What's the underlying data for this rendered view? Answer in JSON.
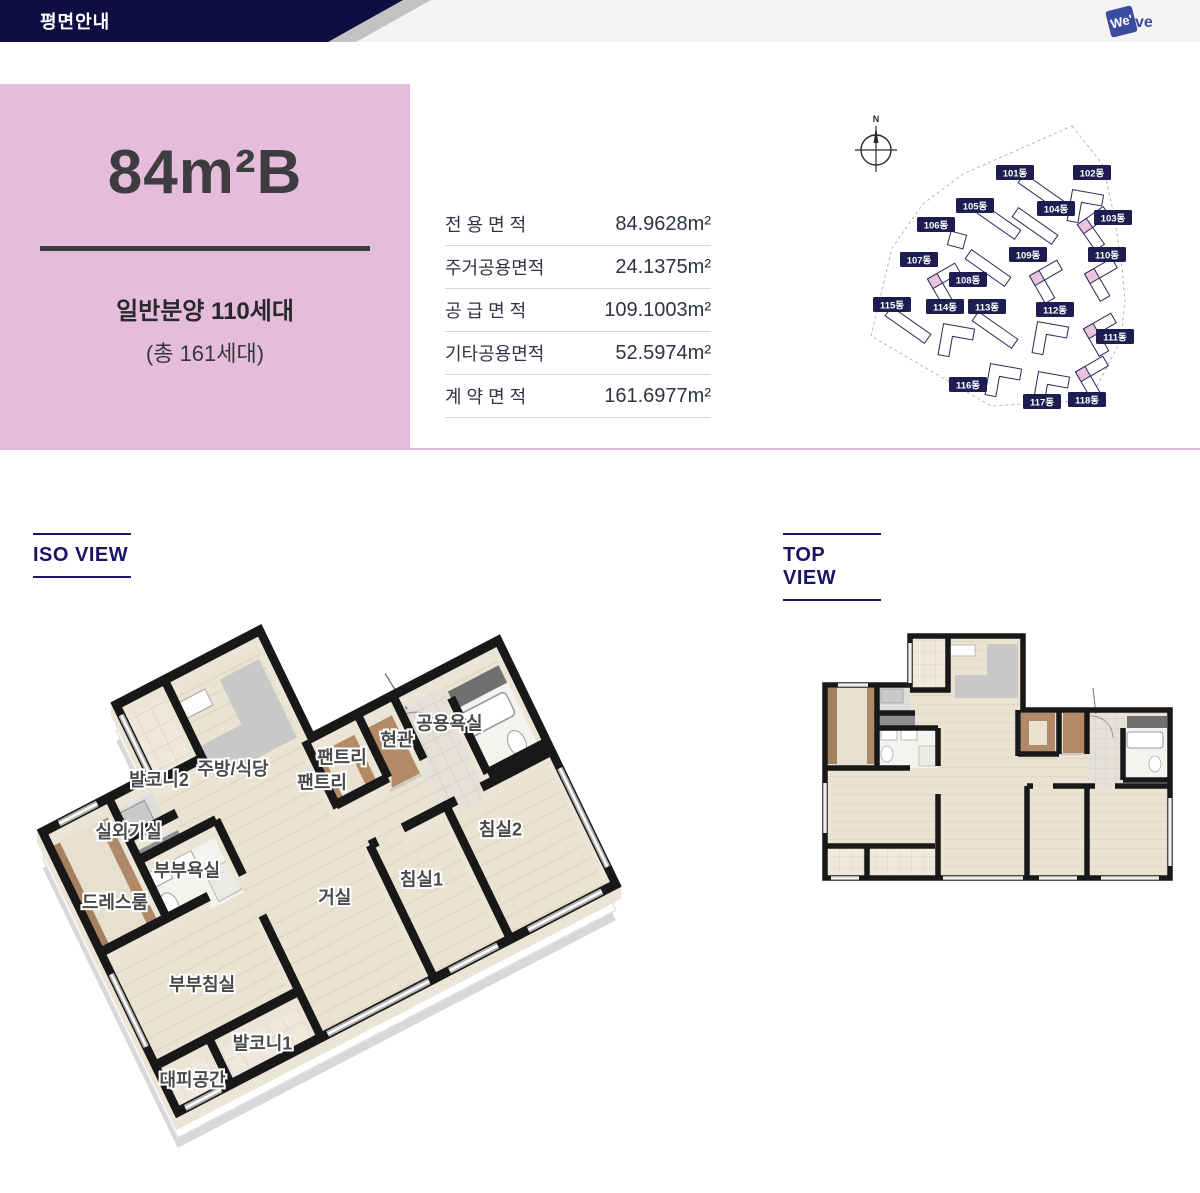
{
  "header": {
    "title": "평면안내",
    "logo": {
      "part1": "We'",
      "part2": "ve"
    }
  },
  "unit": {
    "name": "84m²B",
    "supply_line1": "일반분양 110세대",
    "supply_line2": "(총 161세대)"
  },
  "area_table": {
    "rows": [
      {
        "label": "전 용 면 적",
        "value": "84.9628m²"
      },
      {
        "label": "주거공용면적",
        "value": "24.1375m²"
      },
      {
        "label": "공 급 면 적",
        "value": "109.1003m²"
      },
      {
        "label": "기타공용면적",
        "value": "52.5974m²"
      },
      {
        "label": "계 약 면 적",
        "value": "161.6977m²"
      }
    ]
  },
  "site_map": {
    "compass_label": "N",
    "label_bg": "#1e1c50",
    "highlight_color": "#ecc3dd",
    "buildings": [
      {
        "label": "101동",
        "lx": 170,
        "ly": 65,
        "type": "bar",
        "bx": 196,
        "by": 84,
        "rot": 35,
        "hl": false
      },
      {
        "label": "102동",
        "lx": 247,
        "ly": 65,
        "type": "v",
        "bx": 232,
        "by": 88,
        "rot": 10,
        "hl": false
      },
      {
        "label": "103동",
        "lx": 268,
        "ly": 110,
        "type": "v",
        "bx": 240,
        "by": 118,
        "rot": -35,
        "hl": true
      },
      {
        "label": "104동",
        "lx": 211,
        "ly": 101,
        "type": "bar",
        "bx": 190,
        "by": 118,
        "rot": 35,
        "hl": false
      },
      {
        "label": "105동",
        "lx": 130,
        "ly": 98,
        "type": "bar",
        "bx": 153,
        "by": 113,
        "rot": 35,
        "hl": false
      },
      {
        "label": "106동",
        "lx": 91,
        "ly": 117,
        "type": "sq",
        "bx": 112,
        "by": 132,
        "rot": 15,
        "hl": false
      },
      {
        "label": "107동",
        "lx": 74,
        "ly": 152,
        "type": "v",
        "bx": 90,
        "by": 173,
        "rot": -30,
        "hl": true
      },
      {
        "label": "108동",
        "lx": 123,
        "ly": 172,
        "type": "bar",
        "bx": 143,
        "by": 160,
        "rot": 35,
        "hl": false
      },
      {
        "label": "109동",
        "lx": 183,
        "ly": 147,
        "type": "v",
        "bx": 192,
        "by": 170,
        "rot": -30,
        "hl": true
      },
      {
        "label": "110동",
        "lx": 262,
        "ly": 147,
        "type": "v",
        "bx": 247,
        "by": 168,
        "rot": -30,
        "hl": true
      },
      {
        "label": "111동",
        "lx": 270,
        "ly": 229,
        "type": "v",
        "bx": 246,
        "by": 223,
        "rot": -30,
        "hl": true
      },
      {
        "label": "112동",
        "lx": 210,
        "ly": 202,
        "type": "v",
        "bx": 197,
        "by": 220,
        "rot": 10,
        "hl": false
      },
      {
        "label": "113동",
        "lx": 142,
        "ly": 199,
        "type": "bar",
        "bx": 150,
        "by": 222,
        "rot": 35,
        "hl": false
      },
      {
        "label": "114동",
        "lx": 100,
        "ly": 199,
        "type": "v",
        "bx": 103,
        "by": 222,
        "rot": 10,
        "hl": false
      },
      {
        "label": "115동",
        "lx": 47,
        "ly": 197,
        "type": "bar",
        "bx": 63,
        "by": 217,
        "rot": 35,
        "hl": false
      },
      {
        "label": "116동",
        "lx": 123,
        "ly": 277,
        "type": "v",
        "bx": 150,
        "by": 262,
        "rot": 10,
        "hl": false
      },
      {
        "label": "117동",
        "lx": 197,
        "ly": 294,
        "type": "v",
        "bx": 198,
        "by": 270,
        "rot": 10,
        "hl": false
      },
      {
        "label": "118동",
        "lx": 242,
        "ly": 292,
        "type": "v",
        "bx": 238,
        "by": 266,
        "rot": -30,
        "hl": true
      }
    ]
  },
  "sections": {
    "iso_label": "ISO VIEW",
    "top_label": "TOP VIEW"
  },
  "floor_plan": {
    "rooms": [
      {
        "label": "공용욕실",
        "px": 300,
        "py": 112
      },
      {
        "label": "팬트리",
        "px": 222,
        "py": 100
      },
      {
        "label": "현관",
        "px": 262,
        "py": 106
      },
      {
        "label": "팬트리",
        "px": 202,
        "py": 108
      },
      {
        "label": "주방/식당",
        "px": 150,
        "py": 75
      },
      {
        "label": "발코니2",
        "px": 100,
        "py": 60
      },
      {
        "label": "침실2",
        "px": 300,
        "py": 185
      },
      {
        "label": "실외기실",
        "px": 65,
        "py": 80
      },
      {
        "label": "침실1",
        "px": 235,
        "py": 190
      },
      {
        "label": "부부욕실",
        "px": 90,
        "py": 118
      },
      {
        "label": "드레스룸",
        "px": 35,
        "py": 115
      },
      {
        "label": "거실",
        "px": 175,
        "py": 175
      },
      {
        "label": "부부침실",
        "px": 65,
        "py": 185
      },
      {
        "label": "발코니1",
        "px": 85,
        "py": 235
      },
      {
        "label": "대피공간",
        "px": 30,
        "py": 235
      }
    ]
  },
  "colors": {
    "header_navy": "#100d40",
    "pink": "#e5bcdc",
    "section_navy": "#1b1464",
    "wall_black": "#181818",
    "floor_wood": "#eae3d2"
  }
}
